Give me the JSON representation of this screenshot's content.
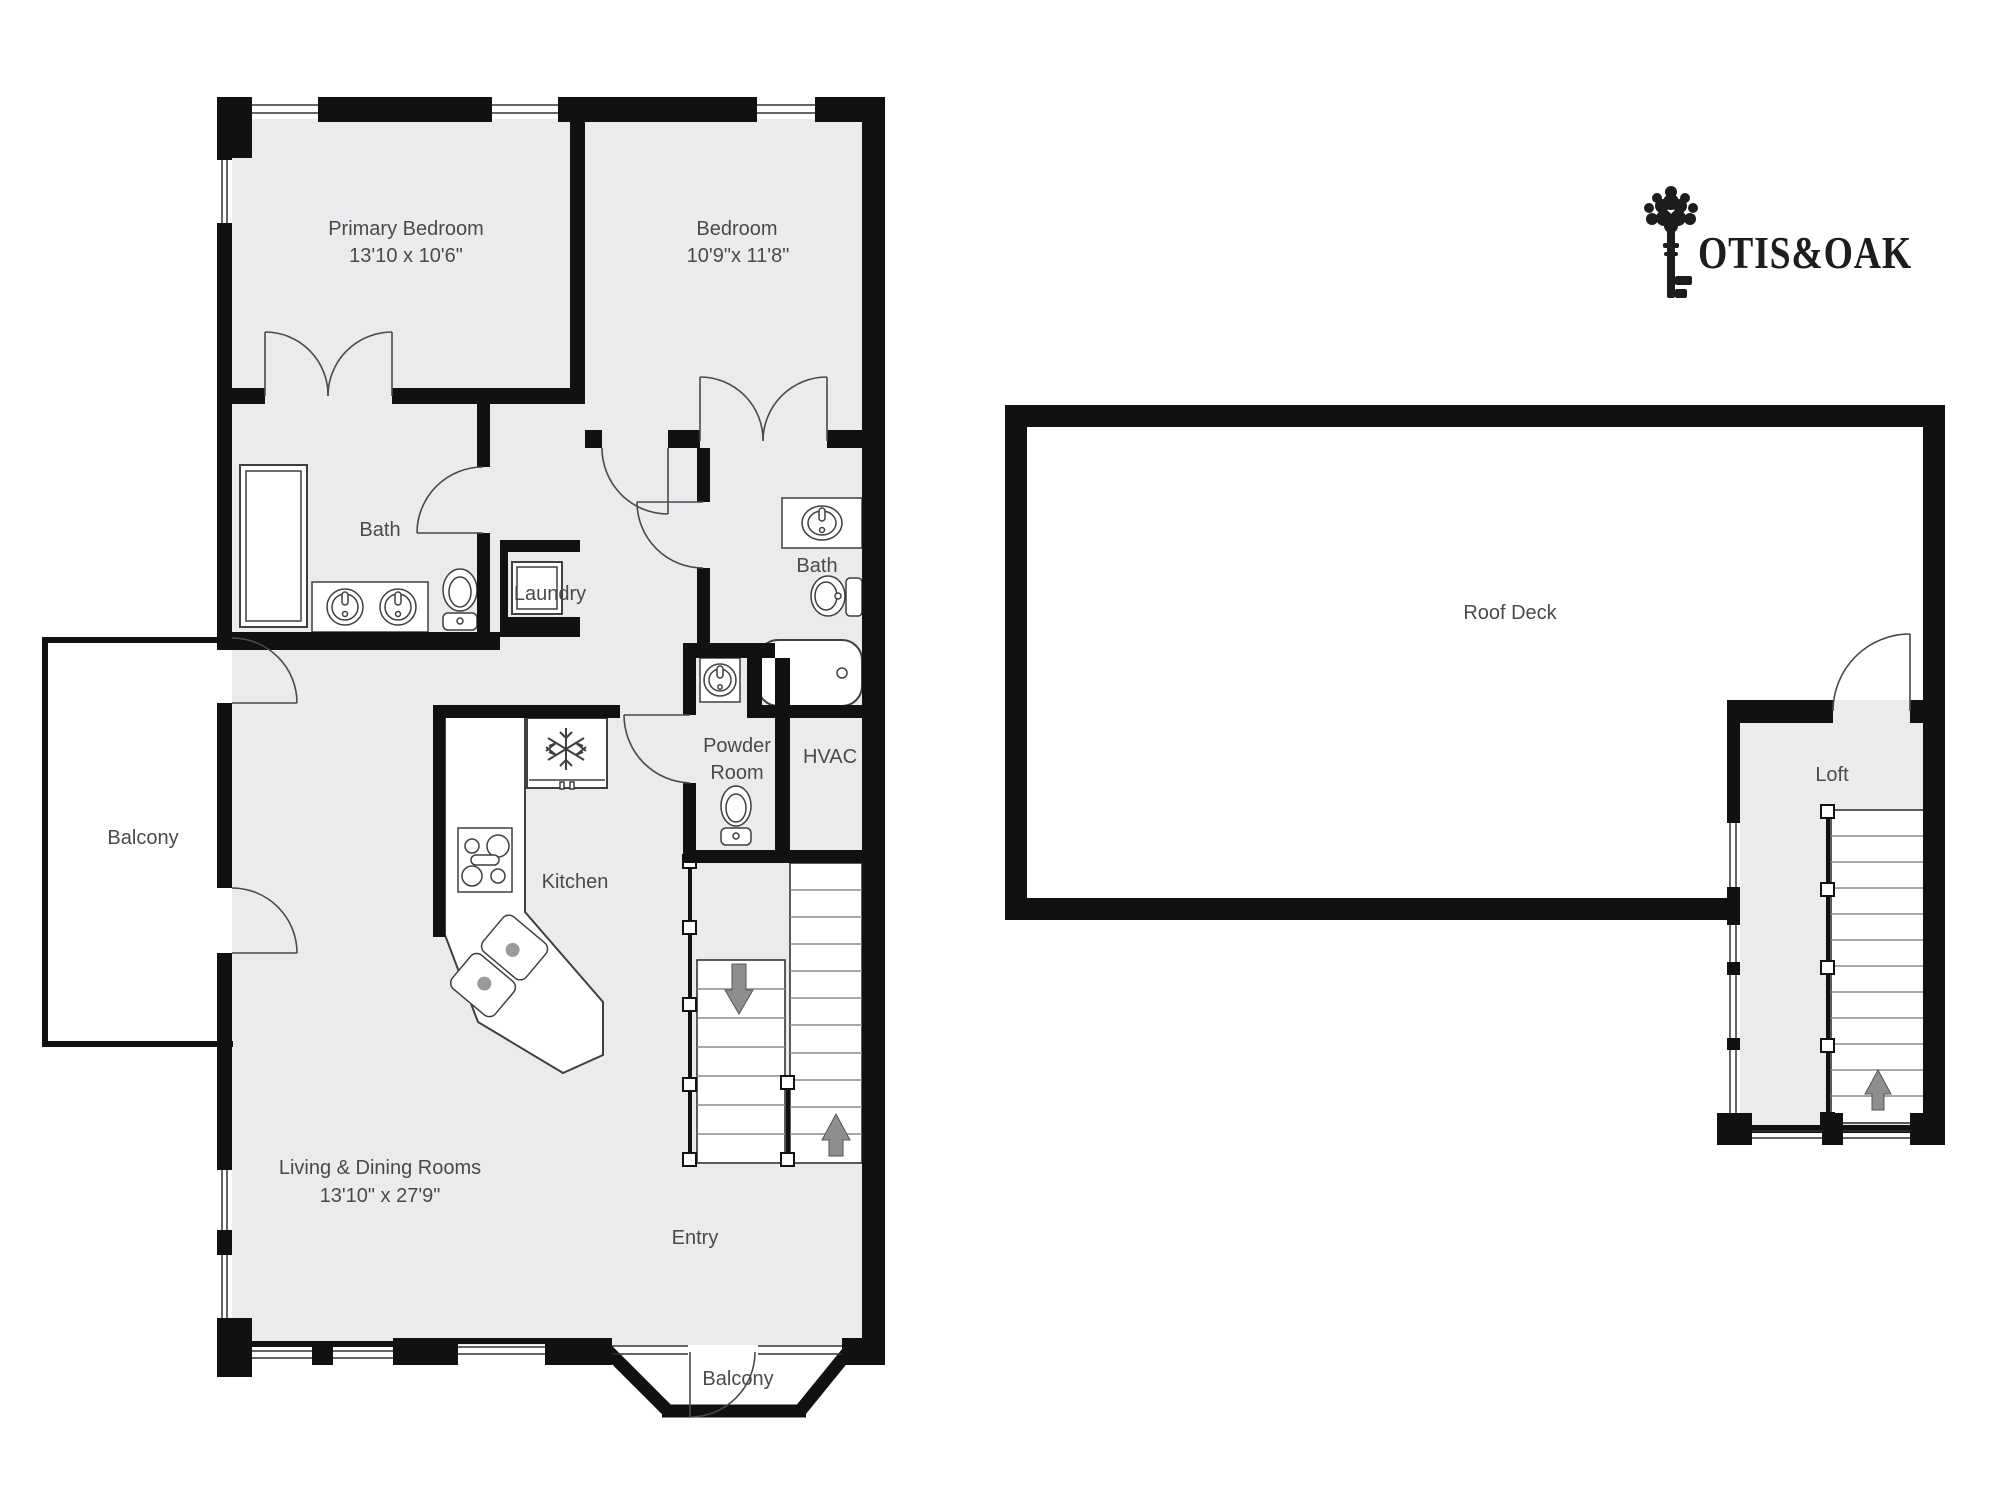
{
  "logo": {
    "brand": "OTIS&OAK"
  },
  "main_floor": {
    "rooms": {
      "primary_bedroom": {
        "label": "Primary Bedroom",
        "dimensions": "13'10 x 10'6\""
      },
      "bedroom": {
        "label": "Bedroom",
        "dimensions": "10'9\"x 11'8\""
      },
      "bath_primary": {
        "label": "Bath"
      },
      "laundry": {
        "label": "Laundry"
      },
      "bath_hall": {
        "label": "Bath"
      },
      "powder_room": {
        "label_line1": "Powder",
        "label_line2": "Room"
      },
      "hvac": {
        "label": "HVAC"
      },
      "kitchen": {
        "label": "Kitchen"
      },
      "living_dining": {
        "label": "Living & Dining Rooms",
        "dimensions": "13'10\" x 27'9\""
      },
      "entry": {
        "label": "Entry"
      },
      "balcony_side": {
        "label": "Balcony"
      },
      "balcony_front": {
        "label": "Balcony"
      }
    }
  },
  "roof_level": {
    "rooms": {
      "roof_deck": {
        "label": "Roof Deck"
      },
      "loft": {
        "label": "Loft"
      }
    }
  },
  "icons": {
    "shower-icon": "svg-shape",
    "sink-icon": "svg-shape",
    "toilet-icon": "svg-shape",
    "bathtub-icon": "svg-shape",
    "washer-icon": "svg-shape",
    "fridge-snowflake-icon": "svg-shape",
    "stove-icon": "svg-shape",
    "kitchen-sink-icon": "svg-shape",
    "stairs-up-arrow-icon": "svg-shape",
    "stairs-down-arrow-icon": "svg-shape",
    "key-tree-logo-icon": "svg-shape"
  },
  "colors": {
    "wall": "#111111",
    "floor": "#ebebed",
    "fixture_stroke": "#3f3f3f",
    "stair_arrow": "#8e8e8e",
    "label_text": "#4a4a4a",
    "logo": "#1d1d1b"
  }
}
